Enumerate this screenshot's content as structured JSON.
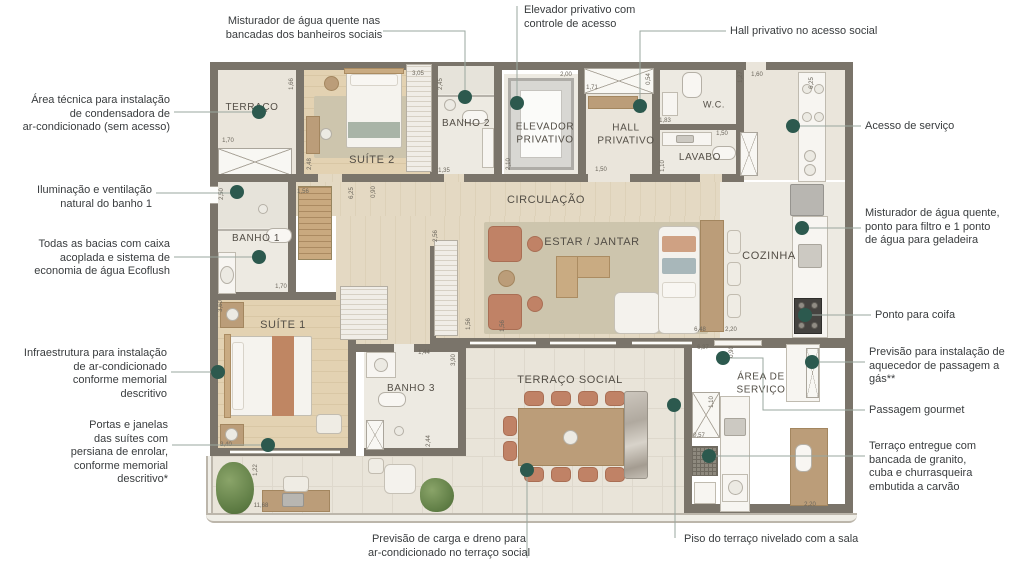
{
  "figure": {
    "type": "apartment-floor-plan",
    "language": "pt-BR"
  },
  "colors": {
    "callout_dot": "#2c594e",
    "leader_line": "#9aa79f",
    "wall": "#7a746a",
    "annotation_text": "#393c3e",
    "room_label_text": "#534e46",
    "dimension_text": "#6b665c",
    "background": "#ffffff"
  },
  "plan": {
    "rooms": [
      {
        "id": "terraco",
        "label": "TERRAÇO",
        "x": 252,
        "y": 108,
        "fs": 10
      },
      {
        "id": "suite2",
        "label": "SUÍTE 2",
        "x": 372,
        "y": 161,
        "fs": 11
      },
      {
        "id": "banho2",
        "label": "BANHO 2",
        "x": 466,
        "y": 124,
        "fs": 10
      },
      {
        "id": "elevador",
        "label": "ELEVADOR\nPRIVATIVO",
        "x": 545,
        "y": 134,
        "fs": 10
      },
      {
        "id": "hall",
        "label": "HALL\nPRIVATIVO",
        "x": 626,
        "y": 135,
        "fs": 10
      },
      {
        "id": "wc",
        "label": "W.C.",
        "x": 714,
        "y": 105,
        "fs": 9
      },
      {
        "id": "lavabo",
        "label": "LAVABO",
        "x": 700,
        "y": 158,
        "fs": 10
      },
      {
        "id": "circulacao",
        "label": "CIRCULAÇÃO",
        "x": 546,
        "y": 201,
        "fs": 11
      },
      {
        "id": "estar-jantar",
        "label": "ESTAR / JANTAR",
        "x": 592,
        "y": 243,
        "fs": 11
      },
      {
        "id": "cozinha",
        "label": "COZINHA",
        "x": 769,
        "y": 257,
        "fs": 11
      },
      {
        "id": "banho1",
        "label": "BANHO 1",
        "x": 256,
        "y": 239,
        "fs": 10
      },
      {
        "id": "suite1",
        "label": "SUÍTE 1",
        "x": 283,
        "y": 326,
        "fs": 11
      },
      {
        "id": "banho3",
        "label": "BANHO 3",
        "x": 411,
        "y": 389,
        "fs": 10
      },
      {
        "id": "terraco-social",
        "label": "TERRAÇO SOCIAL",
        "x": 570,
        "y": 381,
        "fs": 11
      },
      {
        "id": "area-servico",
        "label": "ÁREA DE\nSERVIÇO",
        "x": 761,
        "y": 384,
        "fs": 10
      }
    ],
    "dimensions": [
      {
        "t": "1,70",
        "x": 228,
        "y": 141
      },
      {
        "t": "1,66",
        "x": 292,
        "y": 84,
        "v": 1
      },
      {
        "t": "3,05",
        "x": 418,
        "y": 74
      },
      {
        "t": "2,45",
        "x": 441,
        "y": 84,
        "v": 1
      },
      {
        "t": "2,48",
        "x": 310,
        "y": 164,
        "v": 1
      },
      {
        "t": "1,35",
        "x": 444,
        "y": 171
      },
      {
        "t": "2,10",
        "x": 509,
        "y": 164,
        "v": 1
      },
      {
        "t": "2,00",
        "x": 566,
        "y": 75
      },
      {
        "t": "1,71",
        "x": 592,
        "y": 88
      },
      {
        "t": "0,54",
        "x": 649,
        "y": 79,
        "v": 1
      },
      {
        "t": "1,85",
        "x": 643,
        "y": 107,
        "v": 1
      },
      {
        "t": "1,50",
        "x": 601,
        "y": 170
      },
      {
        "t": "1,83",
        "x": 665,
        "y": 121
      },
      {
        "t": "1,27",
        "x": 741,
        "y": 77,
        "v": 1
      },
      {
        "t": "1,50",
        "x": 722,
        "y": 134
      },
      {
        "t": "1,10",
        "x": 663,
        "y": 166,
        "v": 1
      },
      {
        "t": "1,60",
        "x": 757,
        "y": 75
      },
      {
        "t": "6,25",
        "x": 812,
        "y": 83,
        "v": 1
      },
      {
        "t": "2,50",
        "x": 222,
        "y": 194,
        "v": 1
      },
      {
        "t": "1,56",
        "x": 303,
        "y": 192
      },
      {
        "t": "6,25",
        "x": 352,
        "y": 193,
        "v": 1
      },
      {
        "t": "0,90",
        "x": 374,
        "y": 192,
        "v": 1
      },
      {
        "t": "1,70",
        "x": 281,
        "y": 287
      },
      {
        "t": "3,60",
        "x": 221,
        "y": 306,
        "v": 1
      },
      {
        "t": "2,56",
        "x": 436,
        "y": 236,
        "v": 1
      },
      {
        "t": "1,56",
        "x": 469,
        "y": 324,
        "v": 1
      },
      {
        "t": "1,56",
        "x": 503,
        "y": 326,
        "v": 1
      },
      {
        "t": "3,40",
        "x": 226,
        "y": 445
      },
      {
        "t": "1,22",
        "x": 256,
        "y": 470,
        "v": 1
      },
      {
        "t": "11,68",
        "x": 261,
        "y": 506
      },
      {
        "t": "1,44",
        "x": 424,
        "y": 353
      },
      {
        "t": "3,90",
        "x": 454,
        "y": 360,
        "v": 1
      },
      {
        "t": "2,44",
        "x": 429,
        "y": 441,
        "v": 1
      },
      {
        "t": "6,48",
        "x": 700,
        "y": 330
      },
      {
        "t": "2,20",
        "x": 731,
        "y": 330
      },
      {
        "t": "6,37",
        "x": 703,
        "y": 348
      },
      {
        "t": "0,90",
        "x": 732,
        "y": 352,
        "v": 1
      },
      {
        "t": "1,10",
        "x": 712,
        "y": 402,
        "v": 1
      },
      {
        "t": "0,57",
        "x": 699,
        "y": 436
      },
      {
        "t": "2,20",
        "x": 810,
        "y": 505
      }
    ]
  },
  "annotations": [
    {
      "id": "misturador-banheiros-sociais",
      "align": "center",
      "x": 304,
      "y": 15,
      "text": "Misturador de água quente nas\nbancadas dos banheiros sociais",
      "leader": [
        [
          383,
          31
        ],
        [
          465,
          31
        ],
        [
          465,
          97
        ]
      ],
      "dot": [
        465,
        97
      ]
    },
    {
      "id": "area-tecnica-condensadora",
      "align": "right",
      "x": 170,
      "y": 94,
      "text": "Área técnica para instalação\nde condensadora de\nar-condicionado (sem acesso)",
      "leader": [
        [
          174,
          112
        ],
        [
          259,
          112
        ]
      ],
      "dot": [
        259,
        112
      ]
    },
    {
      "id": "iluminacao-ventilacao-banho1",
      "align": "right",
      "x": 152,
      "y": 184,
      "text": "Iluminação e ventilação\nnatural do banho 1",
      "leader": [
        [
          156,
          193
        ],
        [
          237,
          193
        ]
      ],
      "dot": [
        237,
        192
      ]
    },
    {
      "id": "bacias-ecoflush",
      "align": "right",
      "x": 170,
      "y": 238,
      "text": "Todas as bacias com caixa\nacoplada e sistema de\neconomia de água Ecoflush",
      "leader": [
        [
          174,
          257
        ],
        [
          259,
          257
        ]
      ],
      "dot": [
        259,
        257
      ]
    },
    {
      "id": "infraestrutura-ar-condicionado",
      "align": "right",
      "x": 167,
      "y": 347,
      "text": "Infraestrutura para  instalação\nde ar-condicionado\nconforme memorial\ndescritivo",
      "leader": [
        [
          171,
          372
        ],
        [
          218,
          372
        ]
      ],
      "dot": [
        218,
        372
      ]
    },
    {
      "id": "persiana-de-enrolar",
      "align": "right",
      "x": 168,
      "y": 419,
      "text": "Portas e janelas\ndas suítes  com\npersiana de enrolar,\nconforme memorial\ndescritivo*",
      "leader": [
        [
          172,
          445
        ],
        [
          268,
          445
        ]
      ],
      "dot": [
        268,
        445
      ]
    },
    {
      "id": "elevador-privativo",
      "align": "left",
      "x": 524,
      "y": 4,
      "text": "Elevador privativo com\ncontrole de acesso",
      "leader": [
        [
          517,
          6
        ],
        [
          517,
          103
        ]
      ],
      "dot": [
        517,
        103
      ]
    },
    {
      "id": "hall-privativo",
      "align": "left",
      "x": 730,
      "y": 25,
      "text": "Hall privativo no acesso social",
      "leader": [
        [
          726,
          31
        ],
        [
          640,
          31
        ],
        [
          640,
          106
        ]
      ],
      "dot": [
        640,
        106
      ]
    },
    {
      "id": "acesso-de-servico",
      "align": "left",
      "x": 865,
      "y": 120,
      "text": "Acesso de serviço",
      "leader": [
        [
          861,
          126
        ],
        [
          793,
          126
        ]
      ],
      "dot": [
        793,
        126
      ]
    },
    {
      "id": "misturador-filtro-geladeira",
      "align": "left",
      "x": 865,
      "y": 207,
      "text": "Misturador de água quente,\nponto para filtro e 1 ponto\nde água para geladeira",
      "leader": [
        [
          861,
          228
        ],
        [
          802,
          228
        ]
      ],
      "dot": [
        802,
        228
      ]
    },
    {
      "id": "ponto-para-coifa",
      "align": "left",
      "x": 875,
      "y": 309,
      "text": "Ponto para coifa",
      "leader": [
        [
          871,
          315
        ],
        [
          806,
          315
        ]
      ],
      "dot": [
        805,
        315
      ]
    },
    {
      "id": "aquecedor-passagem-gas",
      "align": "left",
      "x": 869,
      "y": 346,
      "text": "Previsão para instalação de\naquecedor de passagem a\ngás**",
      "leader": [
        [
          865,
          362
        ],
        [
          812,
          362
        ]
      ],
      "dot": [
        812,
        362
      ]
    },
    {
      "id": "passagem-gourmet",
      "align": "left",
      "x": 869,
      "y": 404,
      "text": "Passagem gourmet",
      "leader": [
        [
          865,
          410
        ],
        [
          763,
          410
        ],
        [
          763,
          358
        ],
        [
          723,
          358
        ]
      ],
      "dot": [
        723,
        358
      ]
    },
    {
      "id": "churrasqueira-granito",
      "align": "left",
      "x": 869,
      "y": 440,
      "text": "Terraço entregue com\nbancada de granito,\ncuba e churrasqueira\nembutida a carvão",
      "leader": [
        [
          865,
          456
        ],
        [
          709,
          456
        ]
      ],
      "dot": [
        709,
        456
      ]
    },
    {
      "id": "piso-nivelado",
      "align": "left",
      "x": 684,
      "y": 533,
      "text": "Piso do terraço nivelado com a sala",
      "leader": [
        [
          675,
          538
        ],
        [
          675,
          405
        ]
      ],
      "dot": [
        674,
        405
      ]
    },
    {
      "id": "carga-dreno-ar-condicionado",
      "align": "center",
      "x": 449,
      "y": 533,
      "text": "Previsão de carga e dreno para\nar-condicionado no terraço social",
      "leader": [
        [
          527,
          558
        ],
        [
          527,
          470
        ]
      ],
      "dot": [
        527,
        470
      ]
    }
  ]
}
